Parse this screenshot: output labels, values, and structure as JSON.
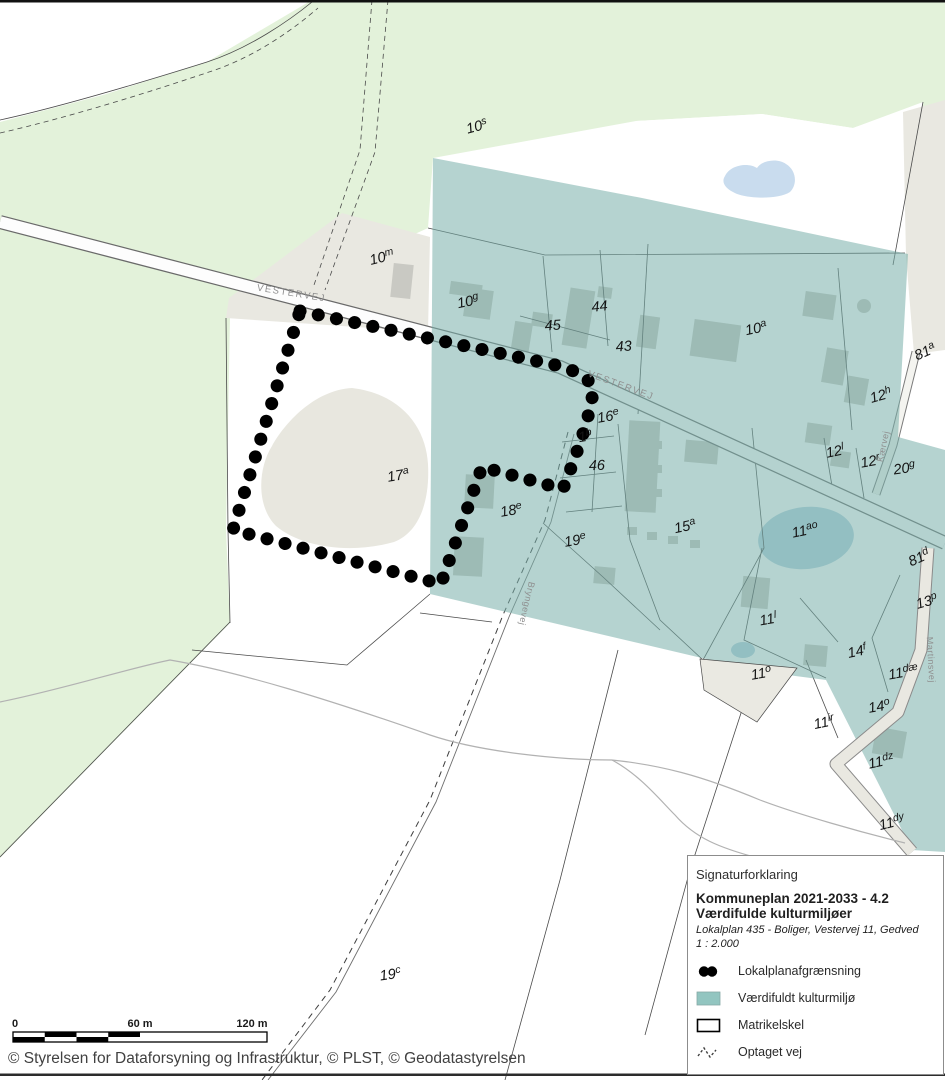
{
  "attribution": "© Styrelsen for Dataforsyning og Infrastruktur, © PLST, © Geodatastyrelsen",
  "scalebar": {
    "t0": "0",
    "t60": "60 m",
    "t120": "120 m"
  },
  "legend": {
    "title": "Signaturforklaring",
    "heading1": "Kommuneplan 2021-2033 - 4.2",
    "heading2": "Værdifulde kulturmiljøer",
    "subtitle": "Lokalplan 435 - Boliger, Vestervej 11, Gedved",
    "scale_text": "1 : 2.000",
    "items": [
      {
        "key": "lokalplan",
        "label": "Lokalplanafgrænsning"
      },
      {
        "key": "kulturmiljo",
        "label": "Værdifuldt kulturmiljø"
      },
      {
        "key": "matrikelskel",
        "label": "Matrikelskel"
      },
      {
        "key": "optaget-vej",
        "label": "Optaget vej"
      }
    ]
  },
  "colors": {
    "kulturmiljo_teal": "#92c5c0",
    "nature_green": "#e3f2da",
    "parcel_beige": "#e9e8e1",
    "building_gray": "#c9c9c3",
    "pond_blue": "#c9dcee",
    "boundary_dots": "#000000"
  },
  "map": {
    "road_labels": [
      {
        "text": "VESTERVEJ",
        "x": 291,
        "y": 296,
        "rot": 9,
        "size": 9.5,
        "ls": 1.6,
        "fill": "#8f8f8f"
      },
      {
        "text": "VESTERVEJ",
        "x": 620,
        "y": 388,
        "rot": 20,
        "size": 9.5,
        "ls": 1.6,
        "fill": "#8f8f8f"
      },
      {
        "text": "Kærvej",
        "x": 886,
        "y": 447,
        "rot": -78,
        "size": 9,
        "ls": 0.5,
        "fill": "#7e9e9a"
      },
      {
        "text": "Bryngevej",
        "x": 524,
        "y": 603,
        "rot": 103,
        "size": 9,
        "ls": 0.5,
        "fill": "#7e9e9a"
      },
      {
        "text": "Martinsvej",
        "x": 928,
        "y": 660,
        "rot": 87,
        "size": 9,
        "ls": 0.5,
        "fill": "#8f9e9b"
      }
    ],
    "parcel_labels": [
      {
        "text": "10s",
        "x": 478,
        "y": 131,
        "rot": -15
      },
      {
        "text": "10m",
        "x": 383,
        "y": 262,
        "rot": -14
      },
      {
        "text": "10g",
        "x": 469,
        "y": 306,
        "rot": -12
      },
      {
        "text": "44",
        "x": 600,
        "y": 311,
        "rot": -6
      },
      {
        "text": "45",
        "x": 553,
        "y": 330,
        "rot": -4
      },
      {
        "text": "43",
        "x": 624,
        "y": 351,
        "rot": -4
      },
      {
        "text": "10a",
        "x": 757,
        "y": 333,
        "rot": -12
      },
      {
        "text": "81a",
        "x": 927,
        "y": 356,
        "rot": -24
      },
      {
        "text": "12h",
        "x": 882,
        "y": 400,
        "rot": -16
      },
      {
        "text": "16e",
        "x": 609,
        "y": 421,
        "rot": -10
      },
      {
        "text": "1b",
        "x": 586,
        "y": 441,
        "rot": -10
      },
      {
        "text": "12l",
        "x": 836,
        "y": 456,
        "rot": -12
      },
      {
        "text": "12r",
        "x": 871,
        "y": 466,
        "rot": -10
      },
      {
        "text": "20g",
        "x": 905,
        "y": 473,
        "rot": -8
      },
      {
        "text": "46",
        "x": 597,
        "y": 470,
        "rot": -2
      },
      {
        "text": "17a",
        "x": 399,
        "y": 480,
        "rot": -10
      },
      {
        "text": "18e",
        "x": 512,
        "y": 515,
        "rot": -10
      },
      {
        "text": "19e",
        "x": 576,
        "y": 545,
        "rot": -10
      },
      {
        "text": "15a",
        "x": 686,
        "y": 531,
        "rot": -12
      },
      {
        "text": "11ao",
        "x": 806,
        "y": 535,
        "rot": -12
      },
      {
        "text": "81d",
        "x": 921,
        "y": 562,
        "rot": -24
      },
      {
        "text": "13p",
        "x": 928,
        "y": 606,
        "rot": -16
      },
      {
        "text": "11l",
        "x": 769,
        "y": 624,
        "rot": -10
      },
      {
        "text": "14f",
        "x": 858,
        "y": 656,
        "rot": -12
      },
      {
        "text": "11o",
        "x": 762,
        "y": 678,
        "rot": -10
      },
      {
        "text": "11dæ",
        "x": 904,
        "y": 677,
        "rot": -10
      },
      {
        "text": "14o",
        "x": 880,
        "y": 711,
        "rot": -10
      },
      {
        "text": "11ir",
        "x": 825,
        "y": 727,
        "rot": -12
      },
      {
        "text": "11dz",
        "x": 882,
        "y": 766,
        "rot": -12
      },
      {
        "text": "11dy",
        "x": 893,
        "y": 827,
        "rot": -14
      },
      {
        "text": "19c",
        "x": 391,
        "y": 979,
        "rot": -8
      }
    ]
  }
}
